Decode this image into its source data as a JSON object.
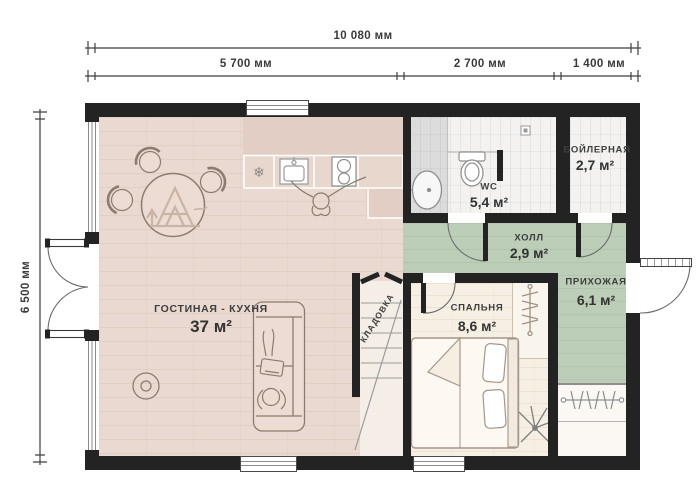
{
  "dimensions": {
    "total_width": "10 080 мм",
    "width_segments": [
      "5 700 мм",
      "2 700 мм",
      "1 400 мм"
    ],
    "total_height": "6 500 мм"
  },
  "rooms": {
    "living": {
      "name": "ГОСТИНАЯ - КУХНЯ",
      "area": "37 м²"
    },
    "wc": {
      "name": "WC",
      "area": "5,4 м²"
    },
    "boiler": {
      "name": "БОЙЛЕРНАЯ",
      "area": "2,7 м²"
    },
    "hall": {
      "name": "ХОЛЛ",
      "area": "2,9 м²"
    },
    "entry": {
      "name": "ПРИХОЖАЯ",
      "area": "6,1 м²"
    },
    "bedroom": {
      "name": "СПАЛЬНЯ",
      "area": "8,6 м²"
    },
    "storage": {
      "name": "КЛАДОВКА"
    }
  },
  "icons": {
    "freezer": "❄"
  },
  "colors": {
    "wall": "#232323",
    "living_floor": "#e9d9d0",
    "kitchen_zone": "#e3cec5",
    "hall_floor": "#bccdb8",
    "bedroom_floor": "#f6efe4",
    "tile_floor": "#f3f2f1",
    "shower_floor": "#dcdcdc",
    "furniture_outline": "#8d7b6f"
  }
}
